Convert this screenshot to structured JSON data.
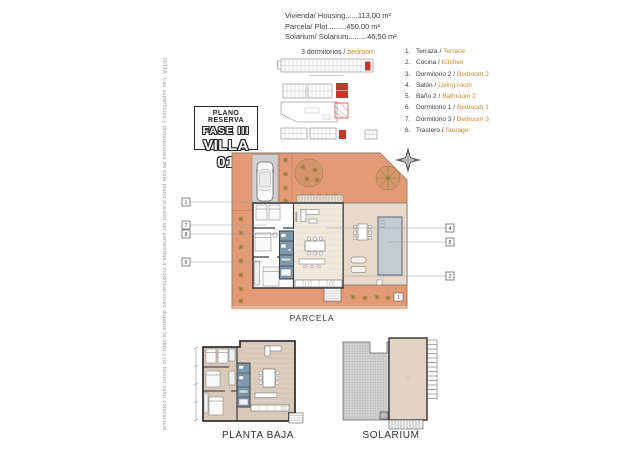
{
  "header": {
    "lines": [
      "Vivienda/ Housing......113,00 m²",
      "Parcela/ Plot.........450,00 m²",
      "Solarium/ Solarium.........46,50 m²"
    ],
    "bedrooms_es": "3 dormitorios /",
    "bedrooms_en": "bedroom"
  },
  "badge": {
    "top": "PLANO RESERVA",
    "phase": "FASE III",
    "villa": "VILLA 01"
  },
  "legend": [
    {
      "num": "1.",
      "es": "Terraza /",
      "en": "Terrace"
    },
    {
      "num": "2.",
      "es": "Cocina /",
      "en": "Kitchen"
    },
    {
      "num": "3.",
      "es": "Dormitorio 2 /",
      "en": "Bedroom 2"
    },
    {
      "num": "4.",
      "es": "Salón /",
      "en": "Living room"
    },
    {
      "num": "5.",
      "es": "Baño 2 /",
      "en": "Bathroom 2"
    },
    {
      "num": "6.",
      "es": "Dormitorio 1 /",
      "en": "Bedroom 1"
    },
    {
      "num": "7.",
      "es": "Dormitorio 3 /",
      "en": "Bedroom 3"
    },
    {
      "num": "8.",
      "es": "Trastero /",
      "en": "Storage"
    }
  ],
  "side_note": "NOTA: Las superficies y dimensiones de este plano pueden ser sometidas a modificaciones durante la obra y no tienen valor contractual.",
  "plans": {
    "parcela": {
      "label": "PARCELA",
      "callouts_left": [
        "1",
        "7",
        "8",
        "6"
      ],
      "callouts_right": [
        "4",
        "5",
        "2"
      ],
      "inner_marker": "1"
    },
    "planta_baja": {
      "label": "PLANTA BAJA"
    },
    "solarium": {
      "label": "SOLARIUM"
    }
  },
  "colors": {
    "parcel_orange": "#e49a74",
    "accent_orange_text": "#c9882e",
    "pool_blue": "#c3ccd4",
    "wet_rooms_blue": "#7e99ac",
    "terrace_beige": "#e7dacb",
    "rooms_tan": "#d9c9b9",
    "driveway_gray": "#cfcfcf",
    "vegetation_olive": "#8c7c35",
    "highlight_red": "#c0392b",
    "walls_dark": "#3a3a3a"
  }
}
